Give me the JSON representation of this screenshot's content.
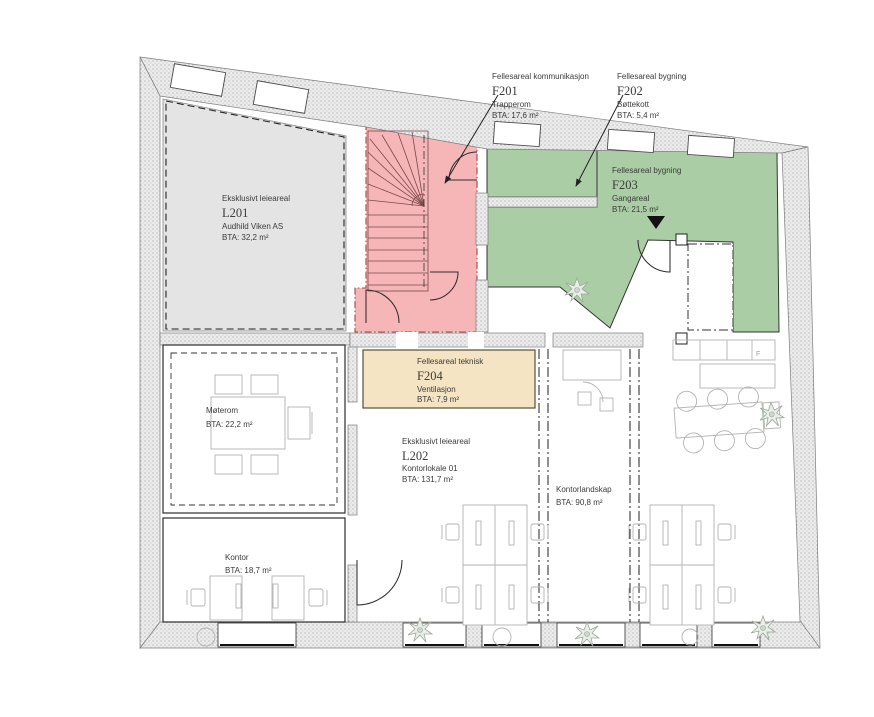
{
  "drawing": {
    "type": "floor-plan",
    "labels": {
      "f201": {
        "category": "Fellesareal kommunikasjon",
        "code": "F201",
        "name": "Trapperom",
        "bta": "BTA: 17,6 m²"
      },
      "f202": {
        "category": "Fellesareal bygning",
        "code": "F202",
        "name": "Bøttekott",
        "bta": "BTA: 5,4 m²"
      },
      "f203": {
        "category": "Fellesareal bygning",
        "code": "F203",
        "name": "Gangareal",
        "bta": "BTA: 21,5 m²"
      },
      "f204": {
        "category": "Fellesareal teknisk",
        "code": "F204",
        "name": "Ventilasjon",
        "bta": "BTA: 7,9 m²"
      },
      "l201": {
        "category": "Eksklusivt leieareal",
        "code": "L201",
        "name": "Audhild Viken AS",
        "bta": "BTA: 32,2 m²"
      },
      "l202": {
        "category": "Eksklusivt leieareal",
        "code": "L202",
        "name": "Kontorlokale 01",
        "bta": "BTA: 131,7 m²"
      },
      "moterom": {
        "name": "Møterom",
        "bta": "BTA: 22,2 m²"
      },
      "kontor": {
        "name": "Kontor",
        "bta": "BTA: 18,7 m²"
      },
      "kontorlandskap": {
        "name": "Kontorlandskap",
        "bta": "BTA: 90,8 m²"
      },
      "kitchen_appliance": "F"
    },
    "colors": {
      "exclusive_area": "#e4e4e4",
      "communication_area": "#f6b6b8",
      "building_common_area": "#abcda5",
      "technical_area": "#f4e4c3"
    }
  }
}
